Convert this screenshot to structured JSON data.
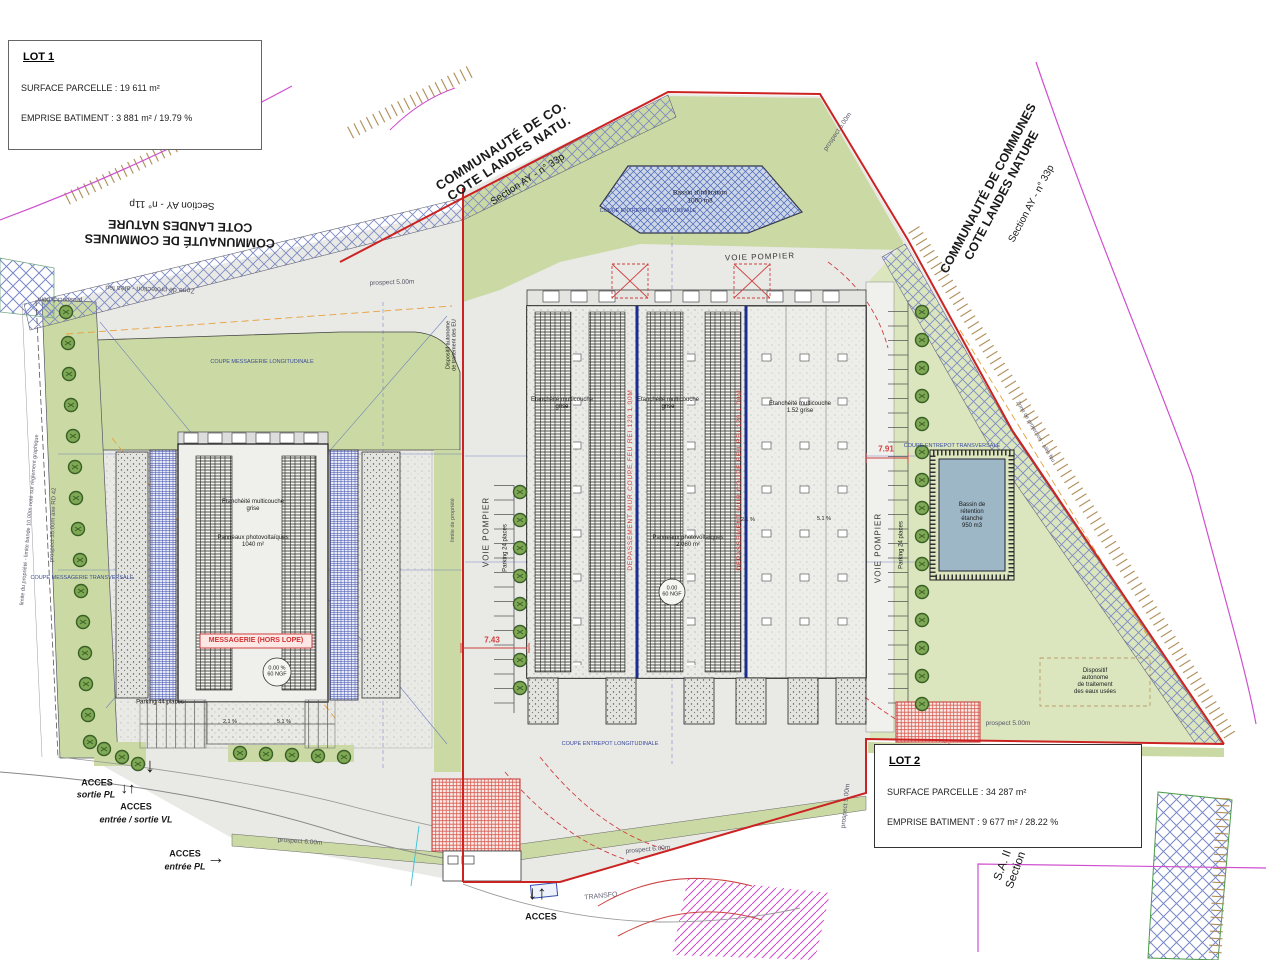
{
  "colors": {
    "boundary_red": "#cc2222",
    "green_band": "#cbdaa4",
    "green_pale": "#dbe6bf",
    "magenta": "#cf4fcf",
    "firewall_blue": "#1b2d8f",
    "annotation_red": "#d04040",
    "basin_fill": "#9db7c6"
  },
  "info_boxes": {
    "lot1": {
      "title": "LOT 1",
      "surface": "SURFACE PARCELLE : 19 611 m²",
      "emprise": "EMPRISE BATIMENT : 3 881 m² / 19.79 %"
    },
    "lot2": {
      "title": "LOT 2",
      "surface": "SURFACE PARCELLE : 34 287 m²",
      "emprise": "EMPRISE BATIMENT : 9 677 m² / 28.22 %"
    }
  },
  "parcel_labels": {
    "top": {
      "lines": "COMMUNAUTÉ DE CO.\nCOTE LANDES NATU.",
      "section": "Section AY - n° 33p"
    },
    "right": {
      "lines": "COMMUNAUTÉ DE COMMUNES\nCOTE LANDES NATURE",
      "section": "Section AY - n° 33p"
    },
    "left": {
      "lines": "COMMUNAUTÉ DE COMMUNES\nCOTE LANDES NATURE",
      "section": "Section AY - n° 11p"
    },
    "bottom_right": "S.A. II\nSection"
  },
  "roads": {
    "voie_pompier": "VOIE POMPIER",
    "transfo": "TRANSFO"
  },
  "parking": {
    "p24": "Parking 24 places",
    "p44": "Parking 44 places"
  },
  "buildings": {
    "messagerie": {
      "etancheite": "Etanchéité multicouche\ngrise",
      "panneaux": "Panneaux photovoltaïques\n1040 m²",
      "tag": "MESSAGERIE (HORS LOPE)",
      "ngf": "0.00 %\n60 NGF",
      "slope_a": "2.1 %",
      "slope_b": "5.1 %"
    },
    "entrepot": {
      "etancheite": "Etanchéité multicouche\ngrise",
      "etancheite_right": "Etanchéité multicouche\n1.52 grise",
      "panneaux": "Panneaux photovoltaïques\n2 080 m²",
      "ngf": "0.00\n60 NGF",
      "mur_coupe_feu": "DEPASSEMENT MUR COUPE FEU REI 120 1.00M",
      "slope_a": "2.1 %",
      "slope_b": "5.1 %"
    }
  },
  "basins": {
    "infiltration": "Bassin d'infiltration\n1000 m3",
    "retention": "Bassin de\nrétention\nétanche\n950 m3"
  },
  "sections": {
    "messagerie_long": "COUPE MESSAGERIE LONGITUDINALE",
    "messagerie_trans": "COUPE MESSAGERIE TRANSVERSALE",
    "entrepot_trans": "COUPE ENTREPOT TRANSVERSALE",
    "entrepot_long": "COUPE ENTREPOT LONGITUDINALE"
  },
  "utilities": {
    "dispositif_eu": "Dispositif autonome\nde traitement des EU",
    "dispositif_eaux": "Dispositif\nautonome\nde traitement\ndes eaux usées"
  },
  "access": {
    "acces": "ACCES",
    "sortie_pl": "sortie PL",
    "entree_sortie_vl": "entrée / sortie VL",
    "entree_pl": "entrée PL"
  },
  "prospects": {
    "p500": "prospect 5.00m",
    "p600": "prospect 6.00m",
    "p3500": "prospect 35.00m axe RD 42"
  },
  "limits": {
    "limite_propriete": "limite de propriété",
    "limite_bande": "limite du propriété - limite bande 10.00m noté sur règlement graphique",
    "zone_protection": "Zone de protection - aléa feu"
  },
  "dimensions": {
    "d743": "7.43",
    "d791": "7.91"
  },
  "icons": {
    "arrow_down": "↓",
    "arrow_up": "↑",
    "arrow_right": "→",
    "arrow_down_up": "↓↑"
  }
}
